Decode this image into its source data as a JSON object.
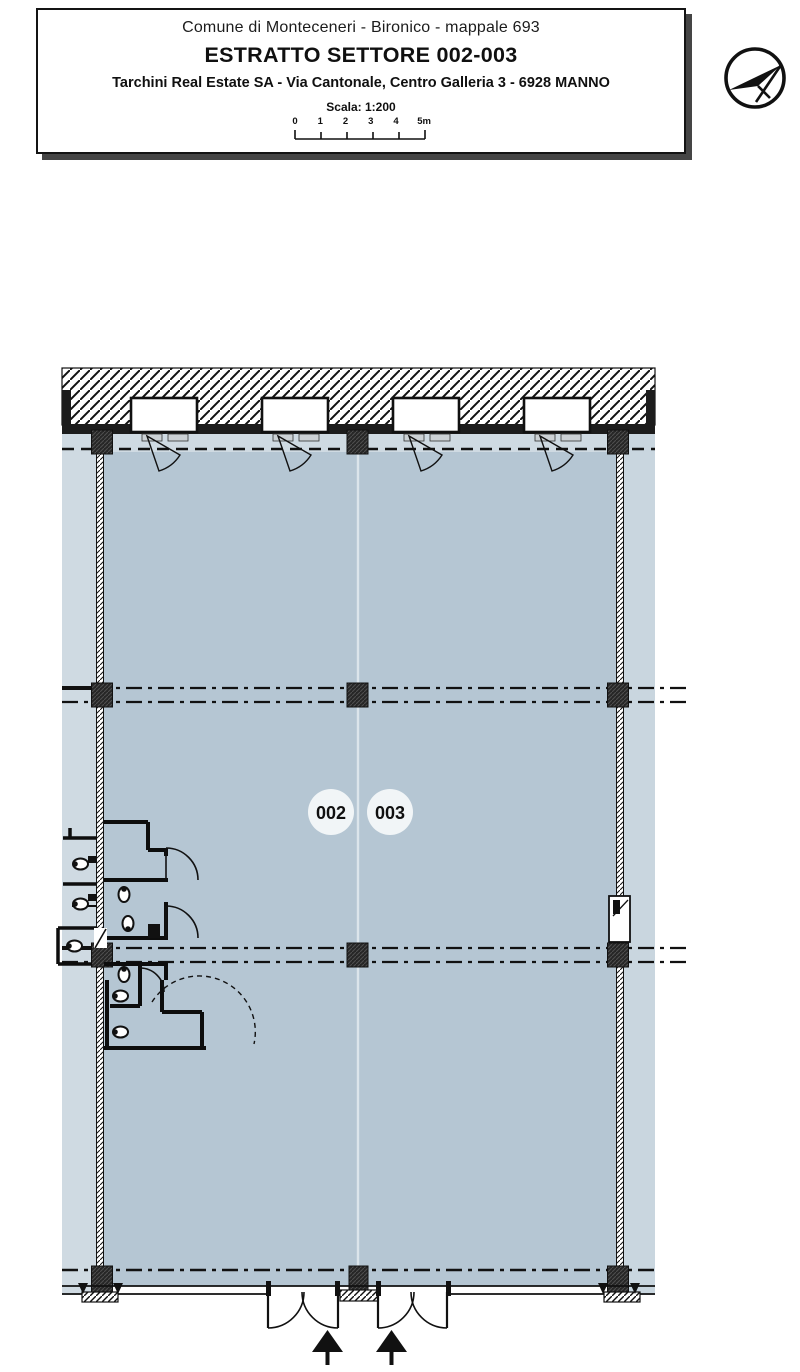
{
  "title_block": {
    "line1": "Comune di Monteceneri -  Bironico - mappale 693",
    "line2": "ESTRATTO SETTORE 002-003",
    "line3": "Tarchini Real Estate SA - Via Cantonale, Centro Galleria 3 - 6928 MANNO",
    "scale_label": "Scala: 1:200",
    "scale_ticks": [
      "0",
      "1",
      "2",
      "3",
      "4",
      "5m"
    ]
  },
  "plan": {
    "sector_left": "002",
    "sector_right": "003"
  },
  "icons": [
    "north-arrow-icon",
    "toilet-icon",
    "entrance-arrow-icon",
    "window-icon",
    "door-swing-icon"
  ],
  "colors": {
    "floor_interior": "#b5c6d3",
    "floor_exterior": "#cfdae2",
    "wall_dark": "#1c1c1c",
    "sector_circle": "#f1f5f7",
    "divider": "#dce5eb"
  }
}
